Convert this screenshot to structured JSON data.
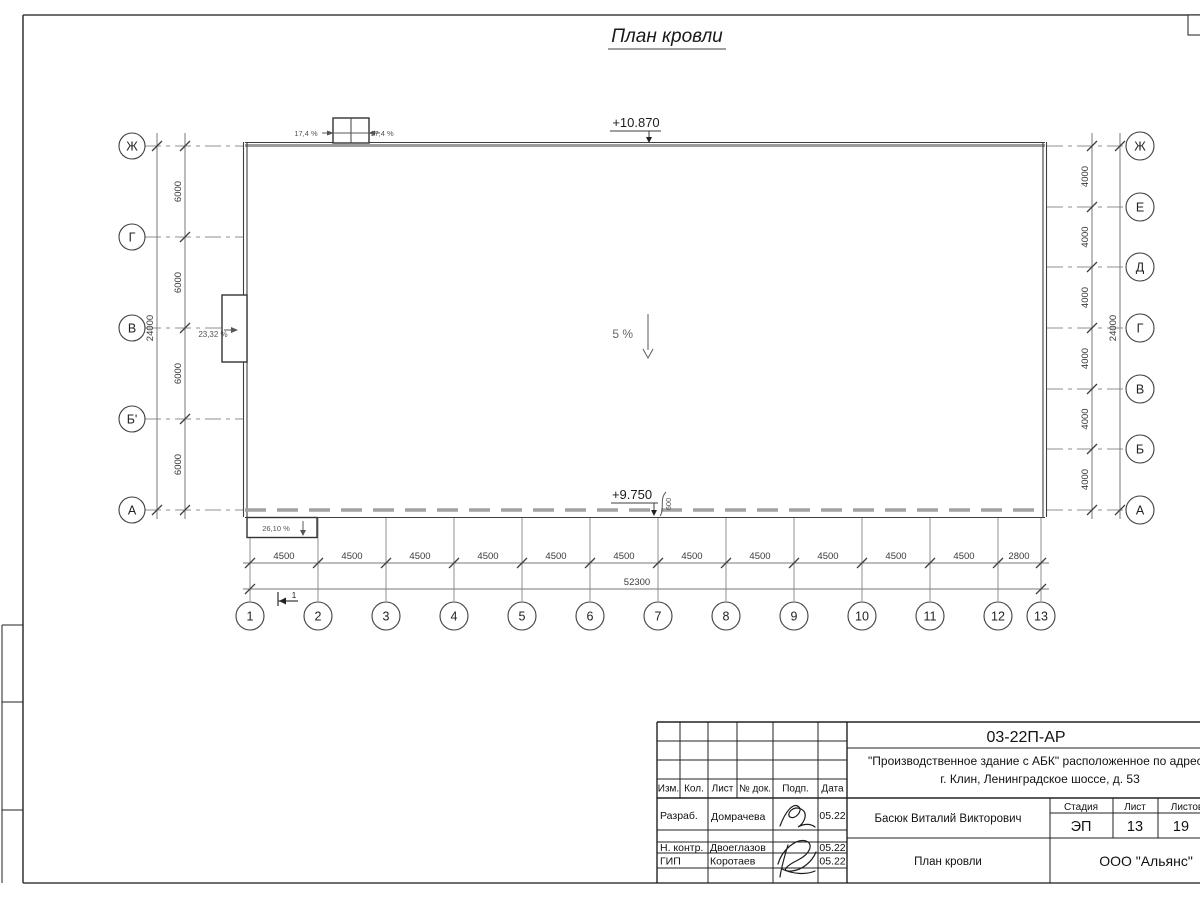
{
  "page": {
    "title": "План кровли"
  },
  "plan": {
    "elevation_top": "+10.870",
    "elevation_bottom": "+9.750",
    "slope_center": "5 %",
    "slope_left": "23,32 %",
    "slope_bottom": "26,10 %",
    "parapet_slope_left": "17,4 %",
    "parapet_slope_right": "17,4 %",
    "overhang_dim": "600",
    "section_mark": "1"
  },
  "axes": {
    "left": {
      "labels": [
        "Ж",
        "Г",
        "В",
        "Б'",
        "А"
      ],
      "bay_dims": [
        "6000",
        "6000",
        "6000",
        "6000"
      ],
      "total_dim": "24000"
    },
    "right": {
      "labels": [
        "Ж",
        "Е",
        "Д",
        "Г",
        "В",
        "Б",
        "А"
      ],
      "bay_dims": [
        "4000",
        "4000",
        "4000",
        "4000",
        "4000",
        "4000"
      ],
      "total_dim": "24000"
    },
    "bottom": {
      "labels": [
        "1",
        "2",
        "3",
        "4",
        "5",
        "6",
        "7",
        "8",
        "9",
        "10",
        "11",
        "12",
        "13"
      ],
      "bay_dims": [
        "4500",
        "4500",
        "4500",
        "4500",
        "4500",
        "4500",
        "4500",
        "4500",
        "4500",
        "4500",
        "4500",
        "2800"
      ],
      "total_dim": "52300"
    }
  },
  "title_block": {
    "doc_number": "03-22П-АР",
    "project_line1": "\"Производственное здание с АБК\" расположенное по адресу:",
    "project_line2": "г. Клин, Ленинградское шоссе, д. 53",
    "rev_headers": [
      "Изм.",
      "Кол.",
      "Лист",
      "№ док.",
      "Подп.",
      "Дата"
    ],
    "roles": [
      {
        "role": "Разраб.",
        "name": "Домрачева",
        "date": "05.22"
      },
      {
        "role": "Н. контр.",
        "name": "Двоеглазов",
        "date": "05.22"
      },
      {
        "role": "ГИП",
        "name": "Коротаев",
        "date": "05.22"
      }
    ],
    "approver": "Басюк Виталий Викторович",
    "stage_header": "Стадия",
    "sheet_header": "Лист",
    "sheets_header": "Листов",
    "stage": "ЭП",
    "sheet": "13",
    "sheets": "19",
    "drawing_title": "План кровли",
    "company": "ООО \"Альянс\""
  },
  "colors": {
    "line_dark": "#3f3f3f",
    "line_gray": "#9c9c9c",
    "paper": "#ffffff"
  }
}
